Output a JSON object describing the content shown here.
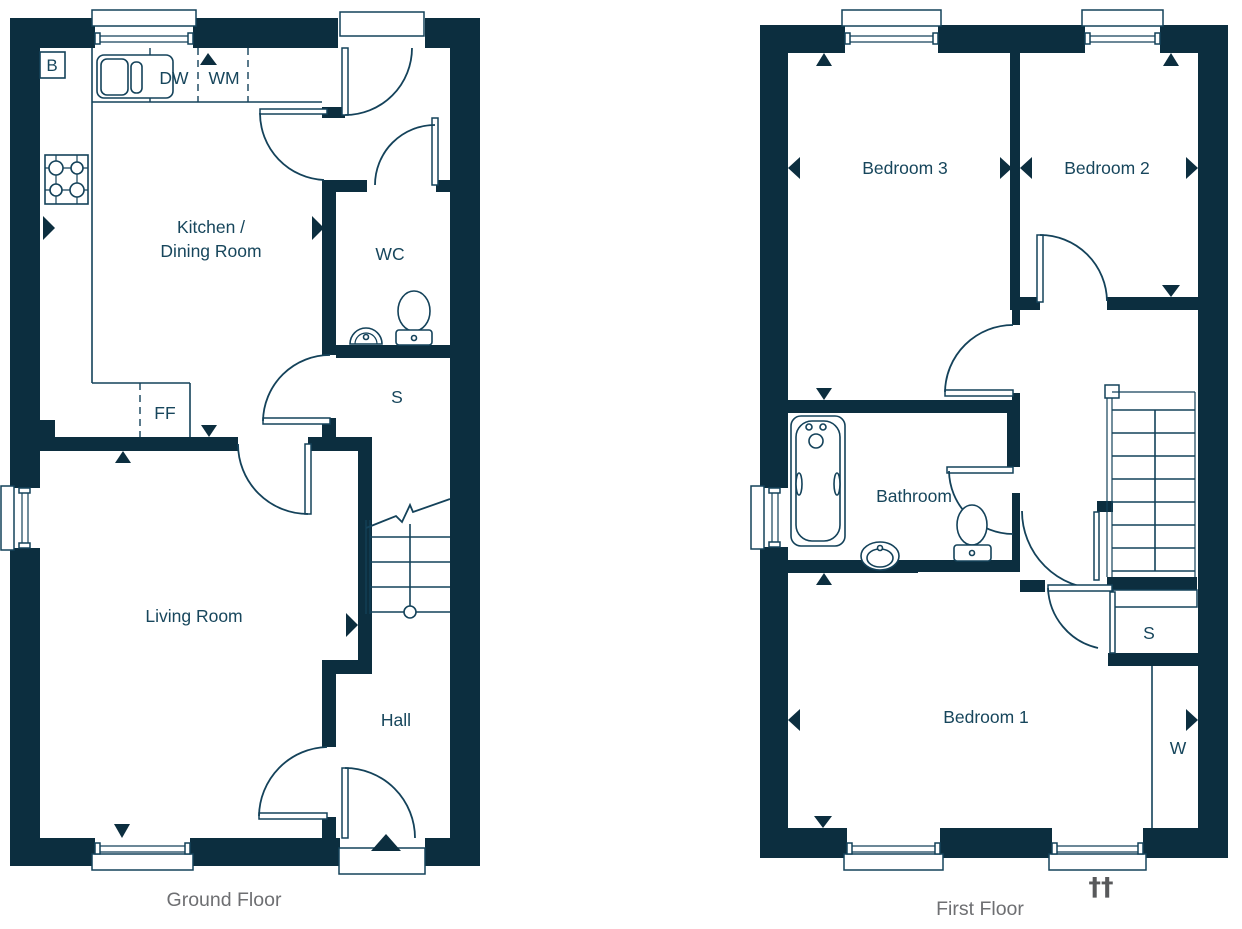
{
  "meta": {
    "colors": {
      "wall": "#0c2e3f",
      "line": "#14425a",
      "label": "#17465c",
      "caption": "#6e6f72",
      "dagger": "#58595b",
      "bg": "#ffffff"
    }
  },
  "ground_floor": {
    "caption": "Ground Floor",
    "rooms": {
      "kitchen_line1": "Kitchen /",
      "kitchen_line2": "Dining Room",
      "wc": "WC",
      "store": "S",
      "hall": "Hall",
      "living": "Living Room"
    },
    "appliances": {
      "boiler": "B",
      "dishwasher": "DW",
      "washing_machine": "WM",
      "fridge_freezer": "FF"
    }
  },
  "first_floor": {
    "caption": "First Floor",
    "rooms": {
      "bedroom3": "Bedroom 3",
      "bedroom2": "Bedroom 2",
      "bathroom": "Bathroom",
      "bedroom1": "Bedroom 1",
      "store": "S",
      "wardrobe": "W"
    },
    "symbols": {
      "daggers": "††"
    }
  }
}
